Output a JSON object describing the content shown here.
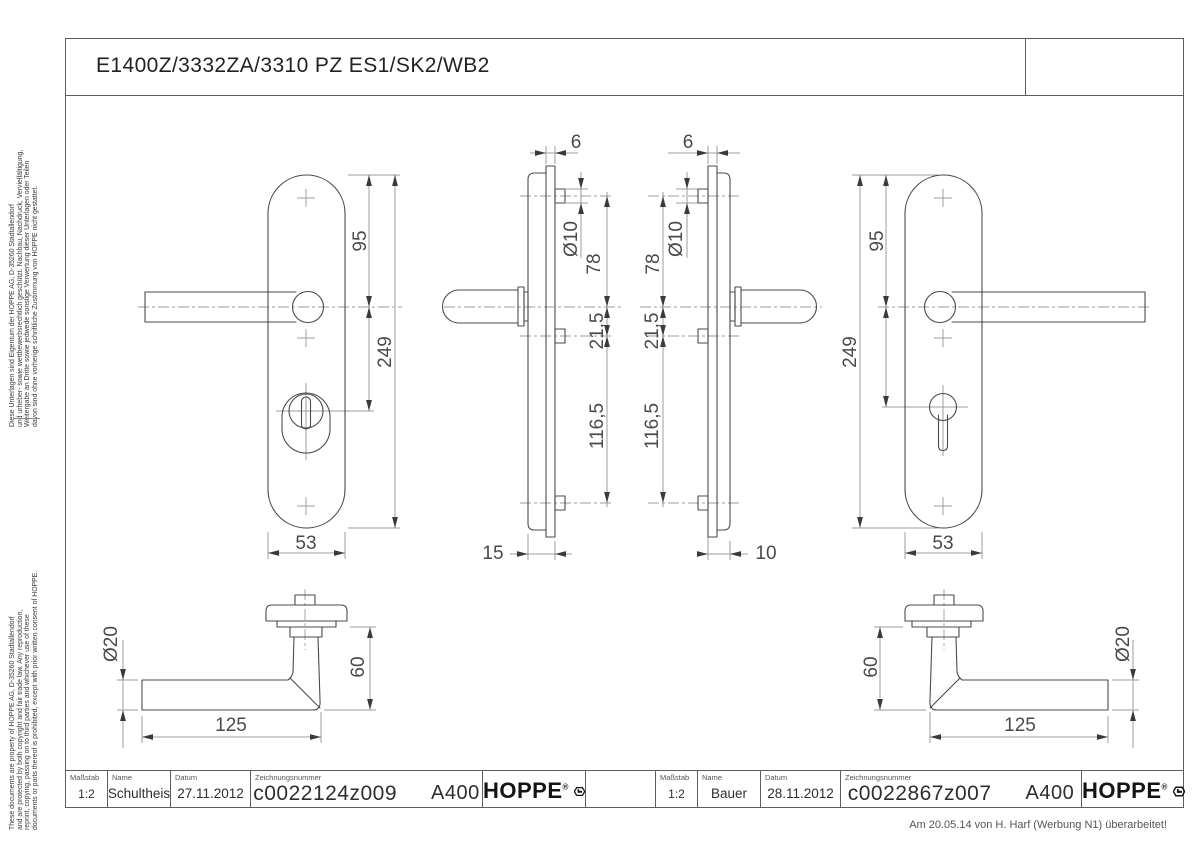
{
  "drawing": {
    "title": "E1400Z/3332ZA/3310 PZ ES1/SK2/WB2",
    "revision_note": "Am 20.05.14 von H. Harf (Werbung N1) überarbeitet!"
  },
  "side_notes": {
    "german": [
      "Diese Unterlagen sind Eigentum der  HOPPE AG, D-35260 Stadtallendorf",
      "und urheber- sowie wettbewerbsrechtlich geschützt. Nachbau, Nachdruck, Vervielfältigung,",
      "Weitergabe an Dritte sowie jedwede sonstige Verwertung dieser Unterlagen oder Teilen",
      "davon sind ohne vorherige schriftliche Zustimmung von HOPPE nicht gestattet."
    ],
    "english": [
      "These documents are property of HOPPE AG, D-35260 Stadtallendorf",
      "and are protected by both copyright and fair trade law. Any reproduction,",
      "reprint, copying, passing on to third parties and whichever use of these",
      "documents or parts thereof is prohibited, except with prior written consent of HOPPE."
    ]
  },
  "field_labels": {
    "scale": "Maßstab",
    "name": "Name",
    "date": "Datum",
    "drawing_number": "Zeichnungsnummer"
  },
  "title_blocks": [
    {
      "scale": "1:2",
      "name": "Schultheis",
      "date": "27.11.2012",
      "drawing_number": "c0022124z009",
      "format": "A400"
    },
    {
      "scale": "1:2",
      "name": "Bauer",
      "date": "28.11.2012",
      "drawing_number": "c0022867z007",
      "format": "A400"
    }
  ],
  "hoppe_logo": {
    "text": "HOPPE",
    "registered": "®"
  },
  "dimensions": {
    "plate_to_handle_axis": "95",
    "plate_length": "249",
    "plate_width": "53",
    "plate_thickness": "6",
    "screw_boss_diameter": "Ø10",
    "top_screw_to_handle_axis": "78",
    "handle_axis_to_middle_screw": "21,5",
    "middle_to_bottom_screw": "116,5",
    "outer_plate_depth": "15",
    "inner_plate_depth": "10",
    "grip_diameter": "Ø20",
    "handle_projection": "60",
    "handle_length": "125"
  }
}
